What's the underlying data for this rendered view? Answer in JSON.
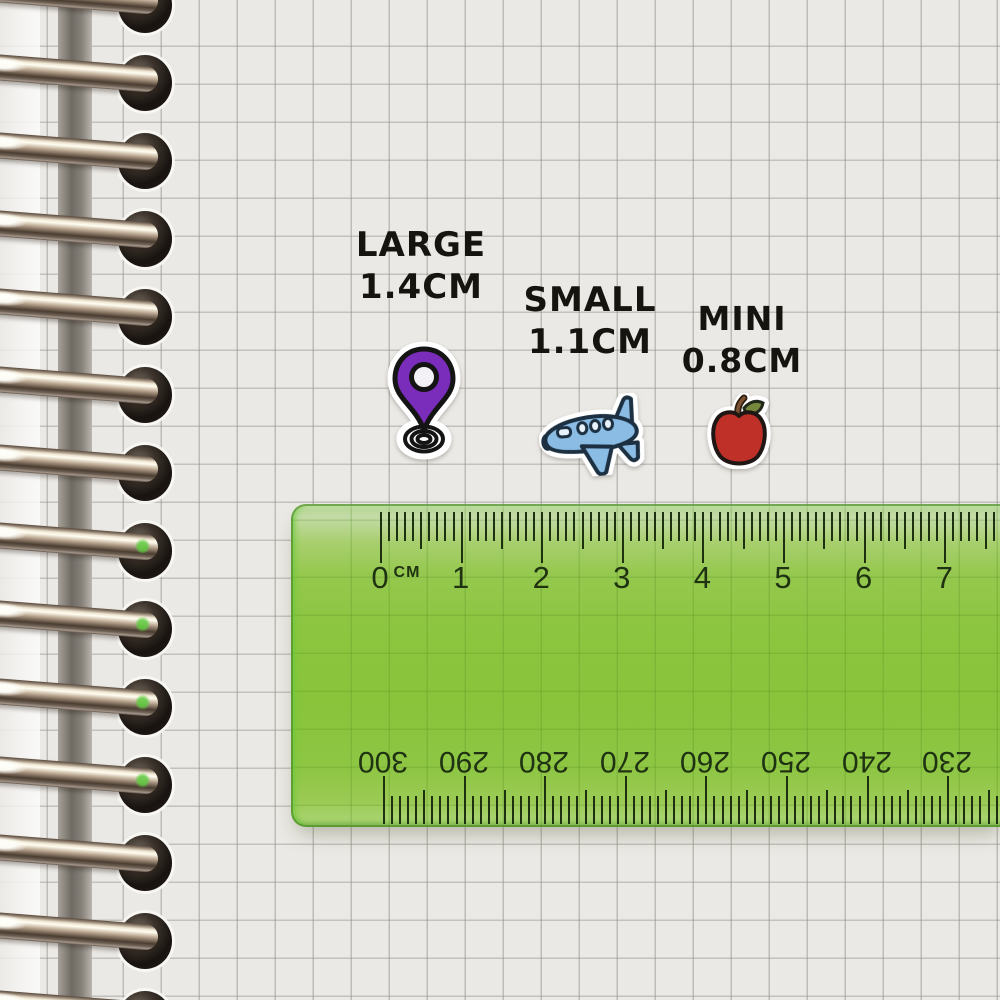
{
  "labels": {
    "large": {
      "name": "LARGE",
      "size": "1.4CM"
    },
    "small": {
      "name": "SMALL",
      "size": "1.1CM"
    },
    "mini": {
      "name": "MINI",
      "size": "0.8CM"
    }
  },
  "ruler": {
    "unit_label": "CM",
    "top_scale_numbers": [
      "0",
      "1",
      "2",
      "3",
      "4",
      "5",
      "6",
      "7"
    ],
    "bottom_scale_numbers": [
      "300",
      "290",
      "280",
      "270",
      "260",
      "250",
      "240",
      "230"
    ]
  },
  "stickers": [
    {
      "name": "location-pin-sticker",
      "label": "LARGE",
      "size_cm": 1.4
    },
    {
      "name": "airplane-sticker",
      "label": "SMALL",
      "size_cm": 1.1
    },
    {
      "name": "apple-sticker",
      "label": "MINI",
      "size_cm": 0.8
    }
  ],
  "binding": {
    "ring_count": 14
  },
  "colors": {
    "paper": "#ebe9e5",
    "ruler_green": "#8cc53f",
    "tick_green": "#1d3010",
    "pin_purple": "#7a2dbb",
    "plane_blue": "#8abce4",
    "apple_red": "#bf3028",
    "label_black": "#16140f"
  }
}
